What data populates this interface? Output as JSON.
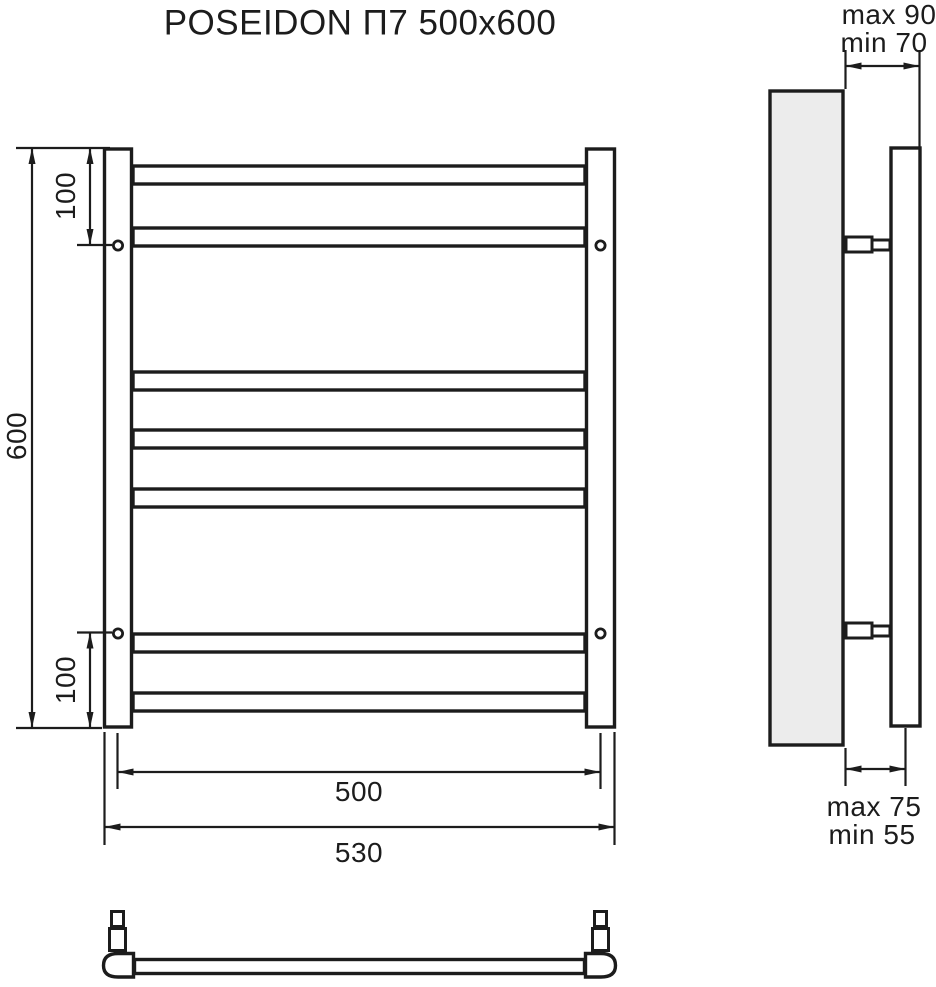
{
  "title": "POSEIDON П7 500x600",
  "front_view": {
    "rung_count": 7,
    "height_label": "600",
    "top_bracket_offset_label": "100",
    "bottom_bracket_offset_label": "100",
    "mount_centers_width_label": "500",
    "overall_width_label": "530"
  },
  "side_view": {
    "top_clearance_max_label": "max 90",
    "top_clearance_min_label": "min 70",
    "bottom_clearance_max_label": "max 75",
    "bottom_clearance_min_label": "min 55"
  },
  "colors": {
    "line": "#1c1c1c",
    "wall_fill": "#ececec",
    "background": "#ffffff"
  }
}
